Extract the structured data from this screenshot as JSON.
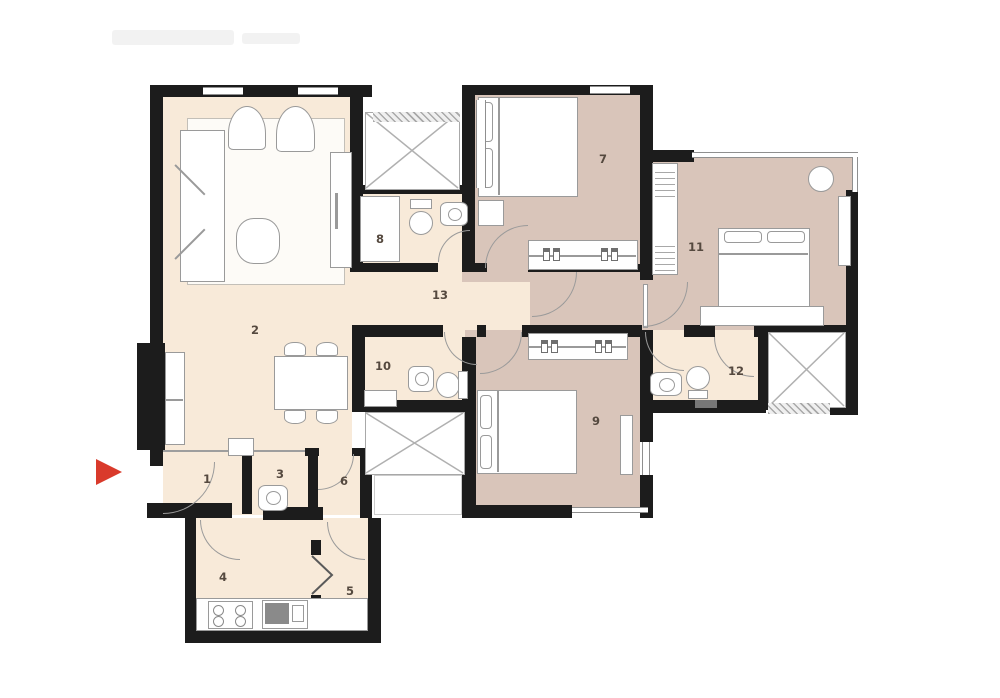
{
  "kind": "apartment-floor-plan",
  "colors": {
    "wall": "#1c1c1c",
    "floor_light": "#f8ead9",
    "floor_dark": "#d9c5ba",
    "fixture_line": "#9a9a9a",
    "entry_arrow": "#d93a2b",
    "room_label": "#55493f"
  },
  "entrance": {
    "icon": "entry-arrow-icon",
    "direction": "right"
  },
  "rooms": [
    {
      "number": "1",
      "features": [
        "entry-door-arc"
      ]
    },
    {
      "number": "2",
      "features": [
        "sofa",
        "armchair",
        "armchair",
        "coffee-table",
        "rug",
        "tv-unit",
        "tall-cabinet",
        "dining-table",
        "dining-chairs"
      ]
    },
    {
      "number": "3",
      "features": [
        "washbasin"
      ]
    },
    {
      "number": "4",
      "features": [
        "hob",
        "kitchen-sink",
        "counter",
        "door-arc"
      ]
    },
    {
      "number": "5",
      "features": [
        "folding-door",
        "door-arc"
      ]
    },
    {
      "number": "6",
      "features": [
        "door-arc"
      ]
    },
    {
      "number": "7",
      "features": [
        "double-bed",
        "wardrobe",
        "bedside-table",
        "door-arc"
      ]
    },
    {
      "number": "8",
      "features": [
        "shower",
        "toilet",
        "washbasin",
        "door-arc"
      ]
    },
    {
      "number": "9",
      "features": [
        "double-bed",
        "wardrobe",
        "dresser",
        "door-arc"
      ]
    },
    {
      "number": "10",
      "features": [
        "shower",
        "toilet",
        "washbasin",
        "door-arc"
      ]
    },
    {
      "number": "11",
      "features": [
        "double-bed",
        "foot-bench",
        "wardrobe",
        "dresser",
        "stool",
        "door-arc"
      ]
    },
    {
      "number": "12",
      "features": [
        "toilet",
        "washbasin",
        "door-arc"
      ]
    },
    {
      "number": "13",
      "features": [
        "passage"
      ]
    }
  ],
  "shafts": [
    {
      "icon": "cross-shaft-icon"
    },
    {
      "icon": "cross-shaft-icon"
    },
    {
      "icon": "cross-shaft-icon"
    }
  ],
  "watermark": {
    "visible": true
  }
}
